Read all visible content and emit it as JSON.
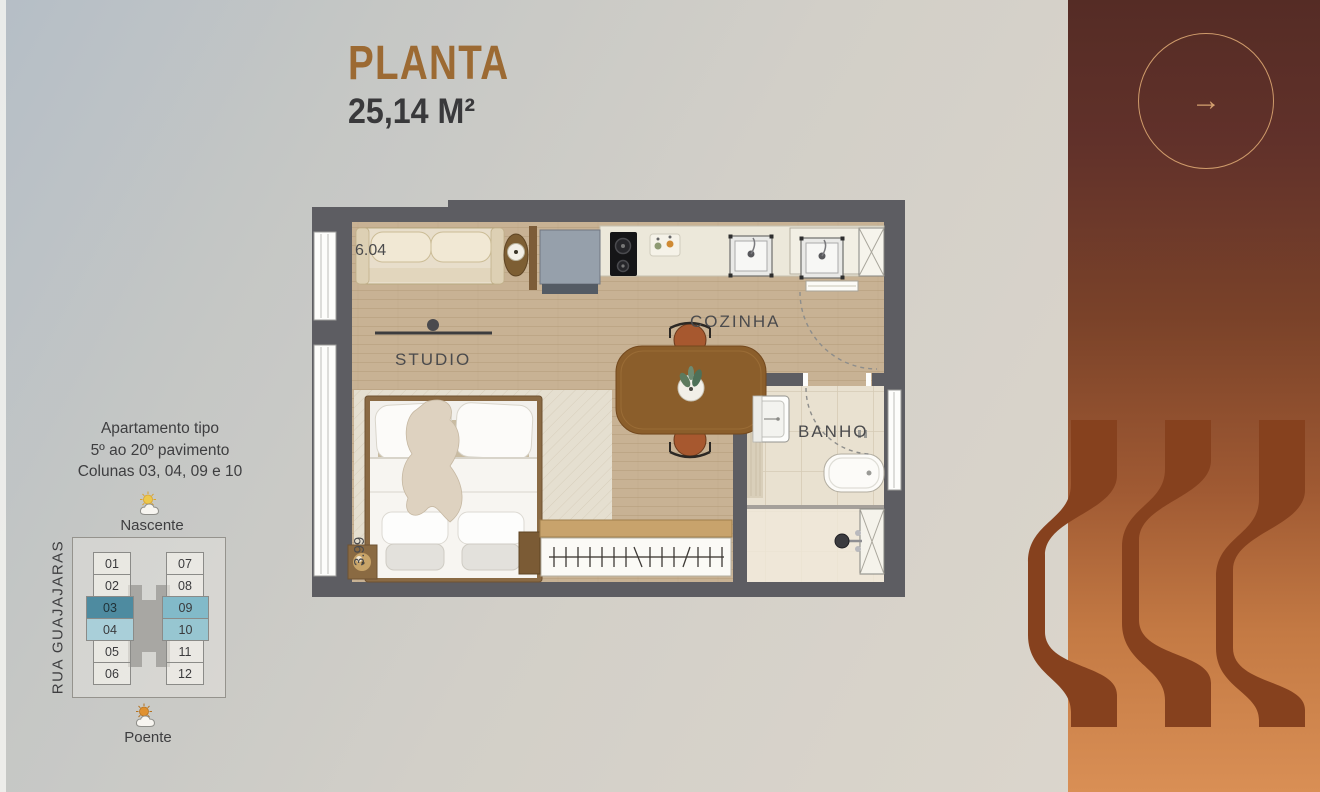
{
  "header": {
    "title": "PLANTA",
    "area": "25,14 M²"
  },
  "apartment_info": {
    "line1": "Apartamento tipo",
    "line2": "5º ao 20º pavimento",
    "line3": "Colunas 03, 04, 09 e 10"
  },
  "orientation": {
    "north": "Nascente",
    "south": "Poente",
    "street": "RUA GUAJAJARAS"
  },
  "building_diagram": {
    "left_units": [
      "01",
      "02",
      "03",
      "04",
      "05",
      "06"
    ],
    "right_units": [
      "07",
      "08",
      "09",
      "10",
      "11",
      "12"
    ],
    "highlighted_units": [
      "03",
      "04",
      "09",
      "10"
    ],
    "highlight_colors": {
      "03": "#4e8ba0",
      "04": "#a9cfd9",
      "09": "#82bac9",
      "10": "#97c6d1"
    }
  },
  "floor_plan": {
    "labels": {
      "studio": "STUDIO",
      "kitchen": "COZINHA",
      "bath": "BANHO"
    },
    "dimensions": {
      "width": "6.04",
      "depth": "3.99"
    }
  },
  "side_panel": {
    "next_arrow": "→"
  },
  "colors": {
    "title": "#9c6a33",
    "wall": "#5d5d62",
    "wood_floor": "#c8b294",
    "panel_top": "#552c25",
    "panel_bottom": "#d98f55",
    "panel_shape": "#86411e",
    "accent_circle": "#cf9b6b"
  }
}
